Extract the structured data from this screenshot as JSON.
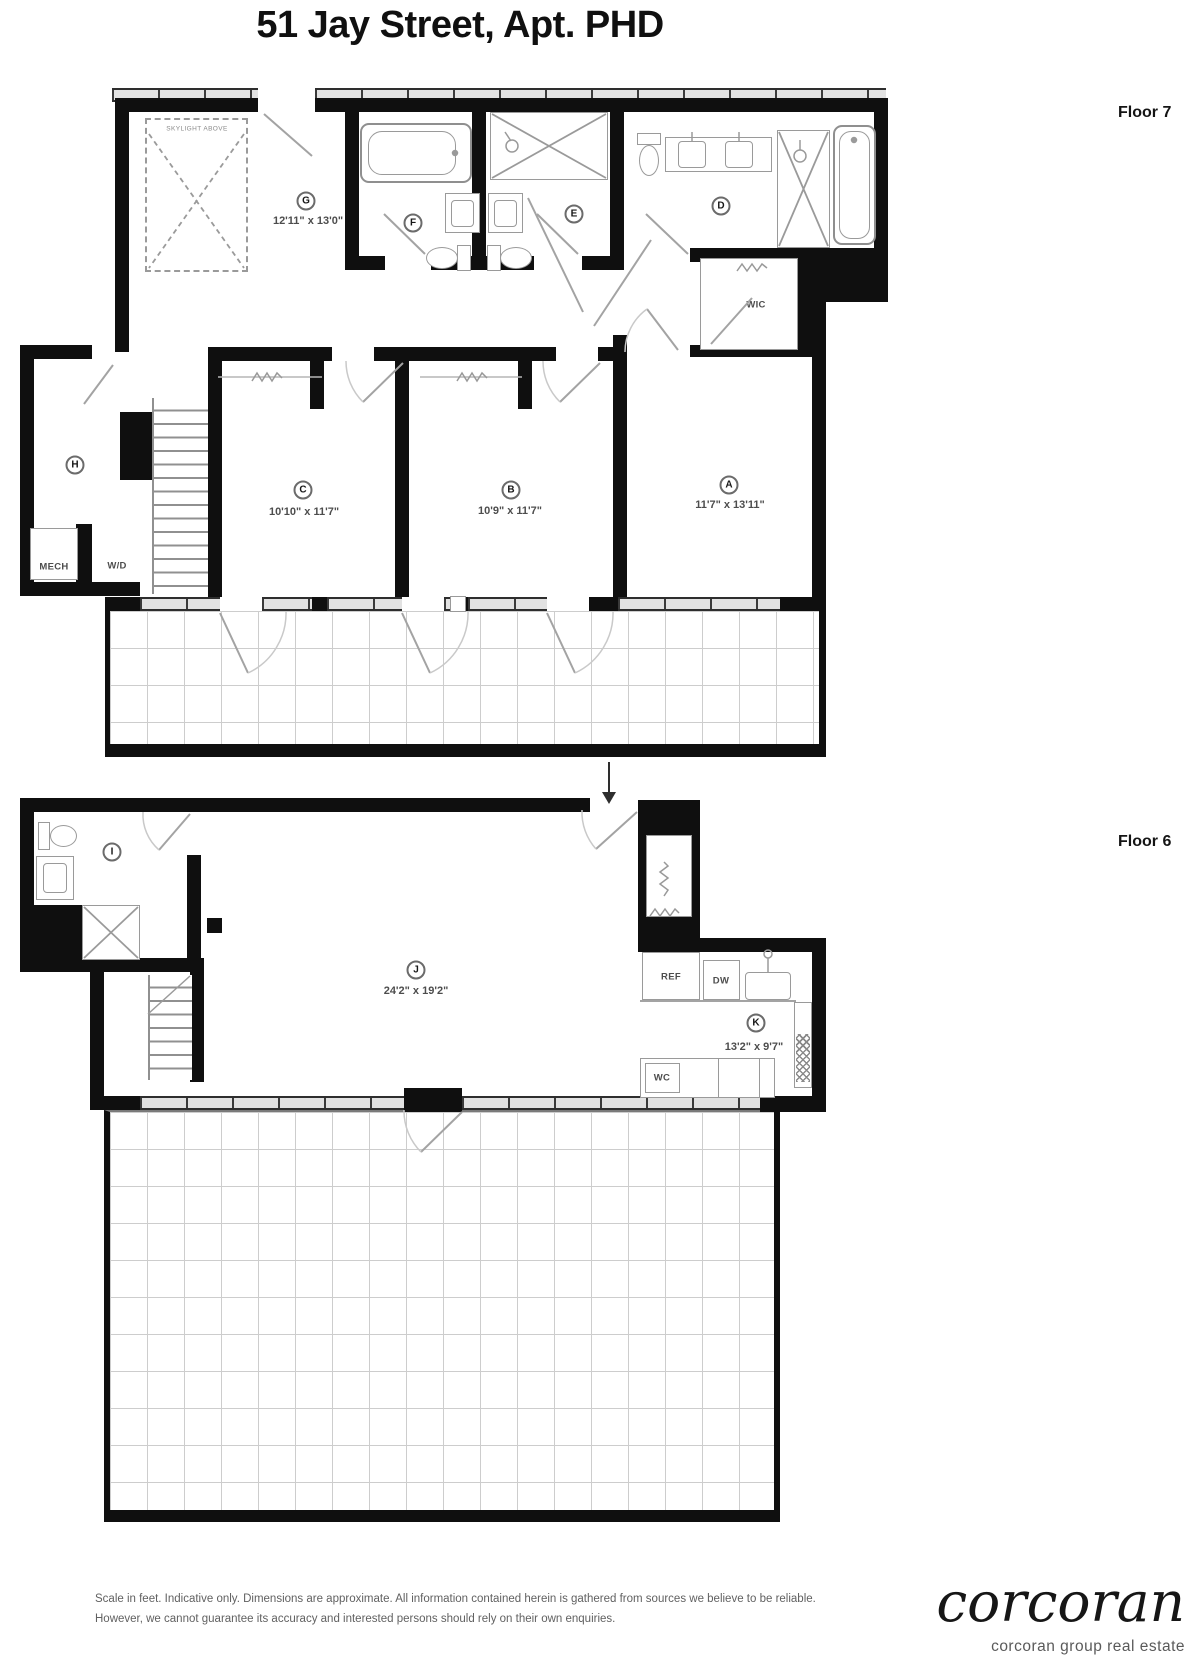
{
  "title": "51 Jay Street, Apt. PHD",
  "colors": {
    "wall": "#0f0f0f",
    "fixture": "#8f8f8f",
    "grid": "#cdcdcd",
    "label_text": "#4d4d4d"
  },
  "floor7": {
    "label": "Floor 7",
    "skylight": "SKYLIGHT ABOVE",
    "roomG": {
      "letter": "G",
      "dims": "12'11\" x 13'0\""
    },
    "roomF": {
      "letter": "F"
    },
    "roomE": {
      "letter": "E"
    },
    "roomD": {
      "letter": "D"
    },
    "roomH": {
      "letter": "H"
    },
    "roomC": {
      "letter": "C",
      "dims": "10'10\" x 11'7\""
    },
    "roomB": {
      "letter": "B",
      "dims": "10'9\" x 11'7\""
    },
    "roomA": {
      "letter": "A",
      "dims": "11'7\" x 13'11\""
    },
    "wic": "WIC",
    "mech": "MECH",
    "wd": "W/D"
  },
  "floor6": {
    "label": "Floor 6",
    "roomI": {
      "letter": "I"
    },
    "roomJ": {
      "letter": "J",
      "dims": "24'2\" x 19'2\""
    },
    "roomK": {
      "letter": "K",
      "dims": "13'2\" x 9'7\""
    },
    "ref": "REF",
    "dw": "DW",
    "wc": "WC"
  },
  "footer": {
    "disclaimer1": "Scale in feet. Indicative only. Dimensions are approximate. All information contained herein is gathered from sources we believe to be reliable.",
    "disclaimer2": "However, we cannot guarantee its accuracy and interested persons should rely on their own enquiries.",
    "brand": "corcoran",
    "brand_tagline": "corcoran group real estate"
  }
}
